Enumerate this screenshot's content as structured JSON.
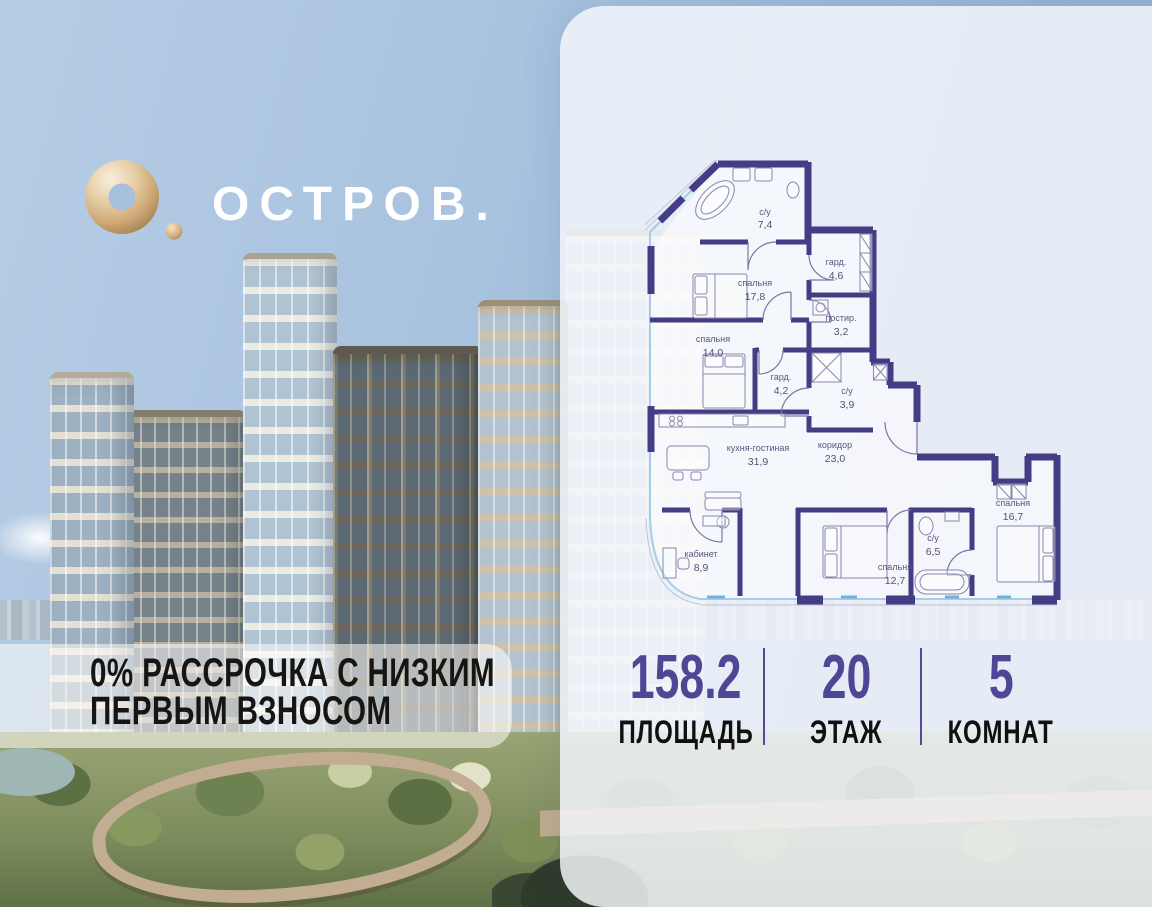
{
  "logo": {
    "brand": "ОСТРОВ."
  },
  "promo": {
    "line1": "0% РАССРОЧКА С НИЗКИМ",
    "line2": "ПЕРВЫМ ВЗНОСОМ"
  },
  "stats": {
    "items": [
      {
        "value": "158.2",
        "label": "ПЛОЩАДЬ"
      },
      {
        "value": "20",
        "label": "ЭТАЖ"
      },
      {
        "value": "5",
        "label": "КОМНАТ"
      }
    ]
  },
  "floorplan": {
    "rooms": [
      {
        "name": "с/у",
        "area": "7,4"
      },
      {
        "name": "спальня",
        "area": "17,8"
      },
      {
        "name": "гард.",
        "area": "4,6"
      },
      {
        "name": "постир.",
        "area": "3,2"
      },
      {
        "name": "спальня",
        "area": "14,0"
      },
      {
        "name": "гард.",
        "area": "4,2"
      },
      {
        "name": "с/у",
        "area": "3,9"
      },
      {
        "name": "кухня-гостиная",
        "area": "31,9"
      },
      {
        "name": "коридор",
        "area": "23,0"
      },
      {
        "name": "кабинет",
        "area": "8,9"
      },
      {
        "name": "спальня",
        "area": "12,7"
      },
      {
        "name": "с/у",
        "area": "6,5"
      },
      {
        "name": "спальня",
        "area": "16,7"
      }
    ]
  },
  "colors": {
    "wall": "#443c85",
    "accent": "#4f4795",
    "gold": "#d9b98c",
    "window": "#a5cce8"
  }
}
